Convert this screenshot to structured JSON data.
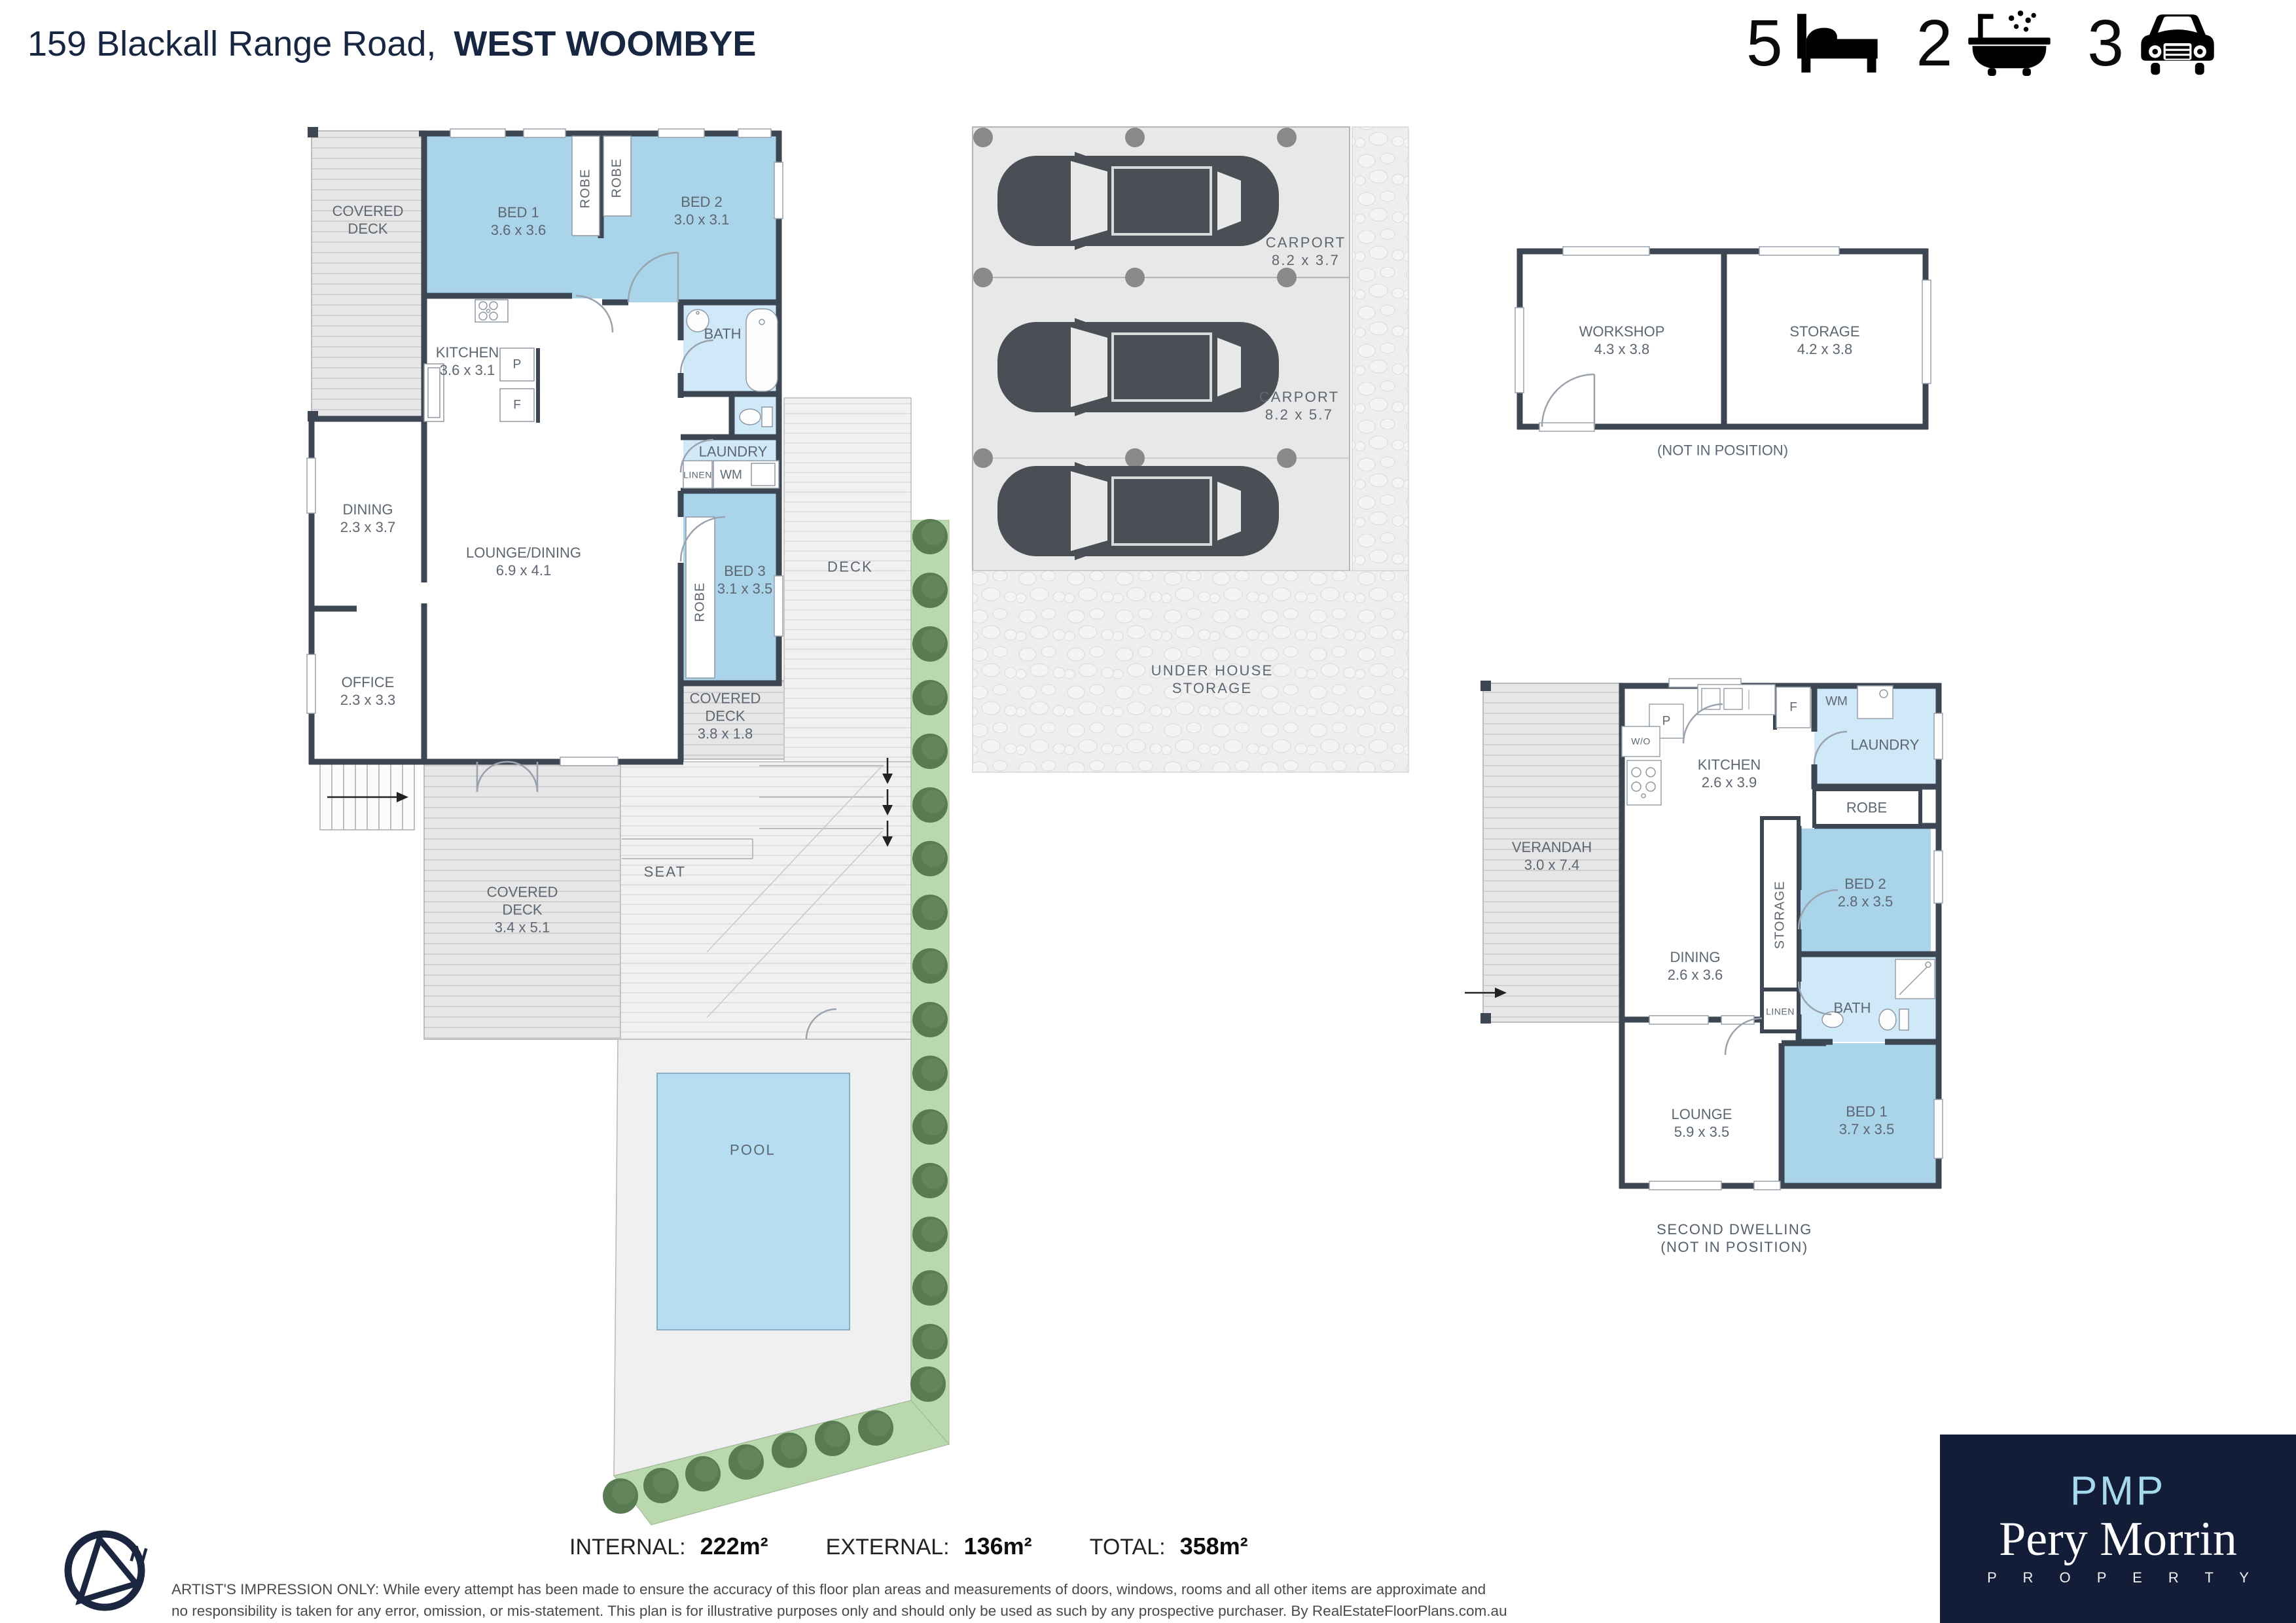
{
  "header": {
    "address": "159 Blackall Range Road,",
    "suburb": "WEST WOOMBYE",
    "stats": {
      "beds": "5",
      "baths": "2",
      "cars": "3"
    }
  },
  "main_house": {
    "covered_deck_left": {
      "l1": "COVERED",
      "l2": "DECK"
    },
    "bed1": {
      "name": "BED 1",
      "dims": "3.6 x 3.6"
    },
    "robe1": "ROBE",
    "robe2": "ROBE",
    "bed2": {
      "name": "BED 2",
      "dims": "3.0 x 3.1"
    },
    "bath": "BATH",
    "kitchen": {
      "name": "KITCHEN",
      "dims": "3.6 x 3.1"
    },
    "pantry": "P",
    "fridge": "F",
    "laundry": "LAUNDRY",
    "linen": "LINEN",
    "wm": "WM",
    "bed3": {
      "name": "BED 3",
      "dims": "3.1 x 3.5"
    },
    "robe3": "ROBE",
    "dining": {
      "name": "DINING",
      "dims": "2.3 x 3.7"
    },
    "office": {
      "name": "OFFICE",
      "dims": "2.3 x 3.3"
    },
    "lounge_dining": {
      "name": "LOUNGE/DINING",
      "dims": "6.9 x 4.1"
    },
    "covered_deck_2": {
      "l1": "COVERED",
      "l2": "DECK",
      "dims": "3.8 x 1.8"
    },
    "covered_deck_3": {
      "l1": "COVERED",
      "l2": "DECK",
      "dims": "3.4 x 5.1"
    },
    "deck": "DECK",
    "seat": "SEAT",
    "pool": "POOL"
  },
  "carport": {
    "c1": {
      "name": "CARPORT",
      "dims": "8.2 x 3.7"
    },
    "c2": {
      "name": "CARPORT",
      "dims": "8.2 x 5.7"
    },
    "under": {
      "l1": "UNDER HOUSE",
      "l2": "STORAGE"
    }
  },
  "outbuilding": {
    "workshop": {
      "name": "WORKSHOP",
      "dims": "4.3 x 3.8"
    },
    "storage": {
      "name": "STORAGE",
      "dims": "4.2 x 3.8"
    },
    "note": "(NOT IN POSITION)"
  },
  "second_dwelling": {
    "verandah": {
      "name": "VERANDAH",
      "dims": "3.0 x 7.4"
    },
    "kitchen": {
      "name": "KITCHEN",
      "dims": "2.6 x 3.9"
    },
    "pantry": "P",
    "wall_oven": "W/O",
    "fridge": "F",
    "wm": "WM",
    "laundry": "LAUNDRY",
    "robe": "ROBE",
    "storage": "STORAGE",
    "bed2": {
      "name": "BED 2",
      "dims": "2.8 x 3.5"
    },
    "dining": {
      "name": "DINING",
      "dims": "2.6 x 3.6"
    },
    "linen": "LINEN",
    "bath": "BATH",
    "lounge": {
      "name": "LOUNGE",
      "dims": "5.9 x 3.5"
    },
    "bed1": {
      "name": "BED 1",
      "dims": "3.7 x 3.5"
    },
    "caption1": "SECOND DWELLING",
    "caption2": "(NOT IN POSITION)"
  },
  "footer": {
    "internal_label": "INTERNAL:",
    "internal_value": "222m²",
    "external_label": "EXTERNAL:",
    "external_value": "136m²",
    "total_label": "TOTAL:",
    "total_value": "358m²",
    "disclaimer_line1": "ARTIST'S IMPRESSION ONLY: While every attempt has been made to ensure the accuracy of this floor plan areas and measurements of doors, windows, rooms and all other items are approximate and",
    "disclaimer_line2": "no responsibility is taken for any error, omission, or mis-statement. This plan is for illustrative purposes only and should only be used as such by any prospective purchaser. By RealEstateFloorPlans.com.au"
  },
  "logo": {
    "monogram": "PMP",
    "name": "Pery Morrin",
    "tagline": "P R O P E R T Y"
  },
  "compass": {
    "north": "N"
  },
  "colors": {
    "wall": "#3d4753",
    "room_blue": "#a9d4e9",
    "wet_blue": "#d0e9f8",
    "pool_blue": "#b6def2",
    "garden_green": "#b9d8ae",
    "tree_green": "#597b51",
    "navy": "#141d38",
    "label_grey": "#5d6772"
  }
}
